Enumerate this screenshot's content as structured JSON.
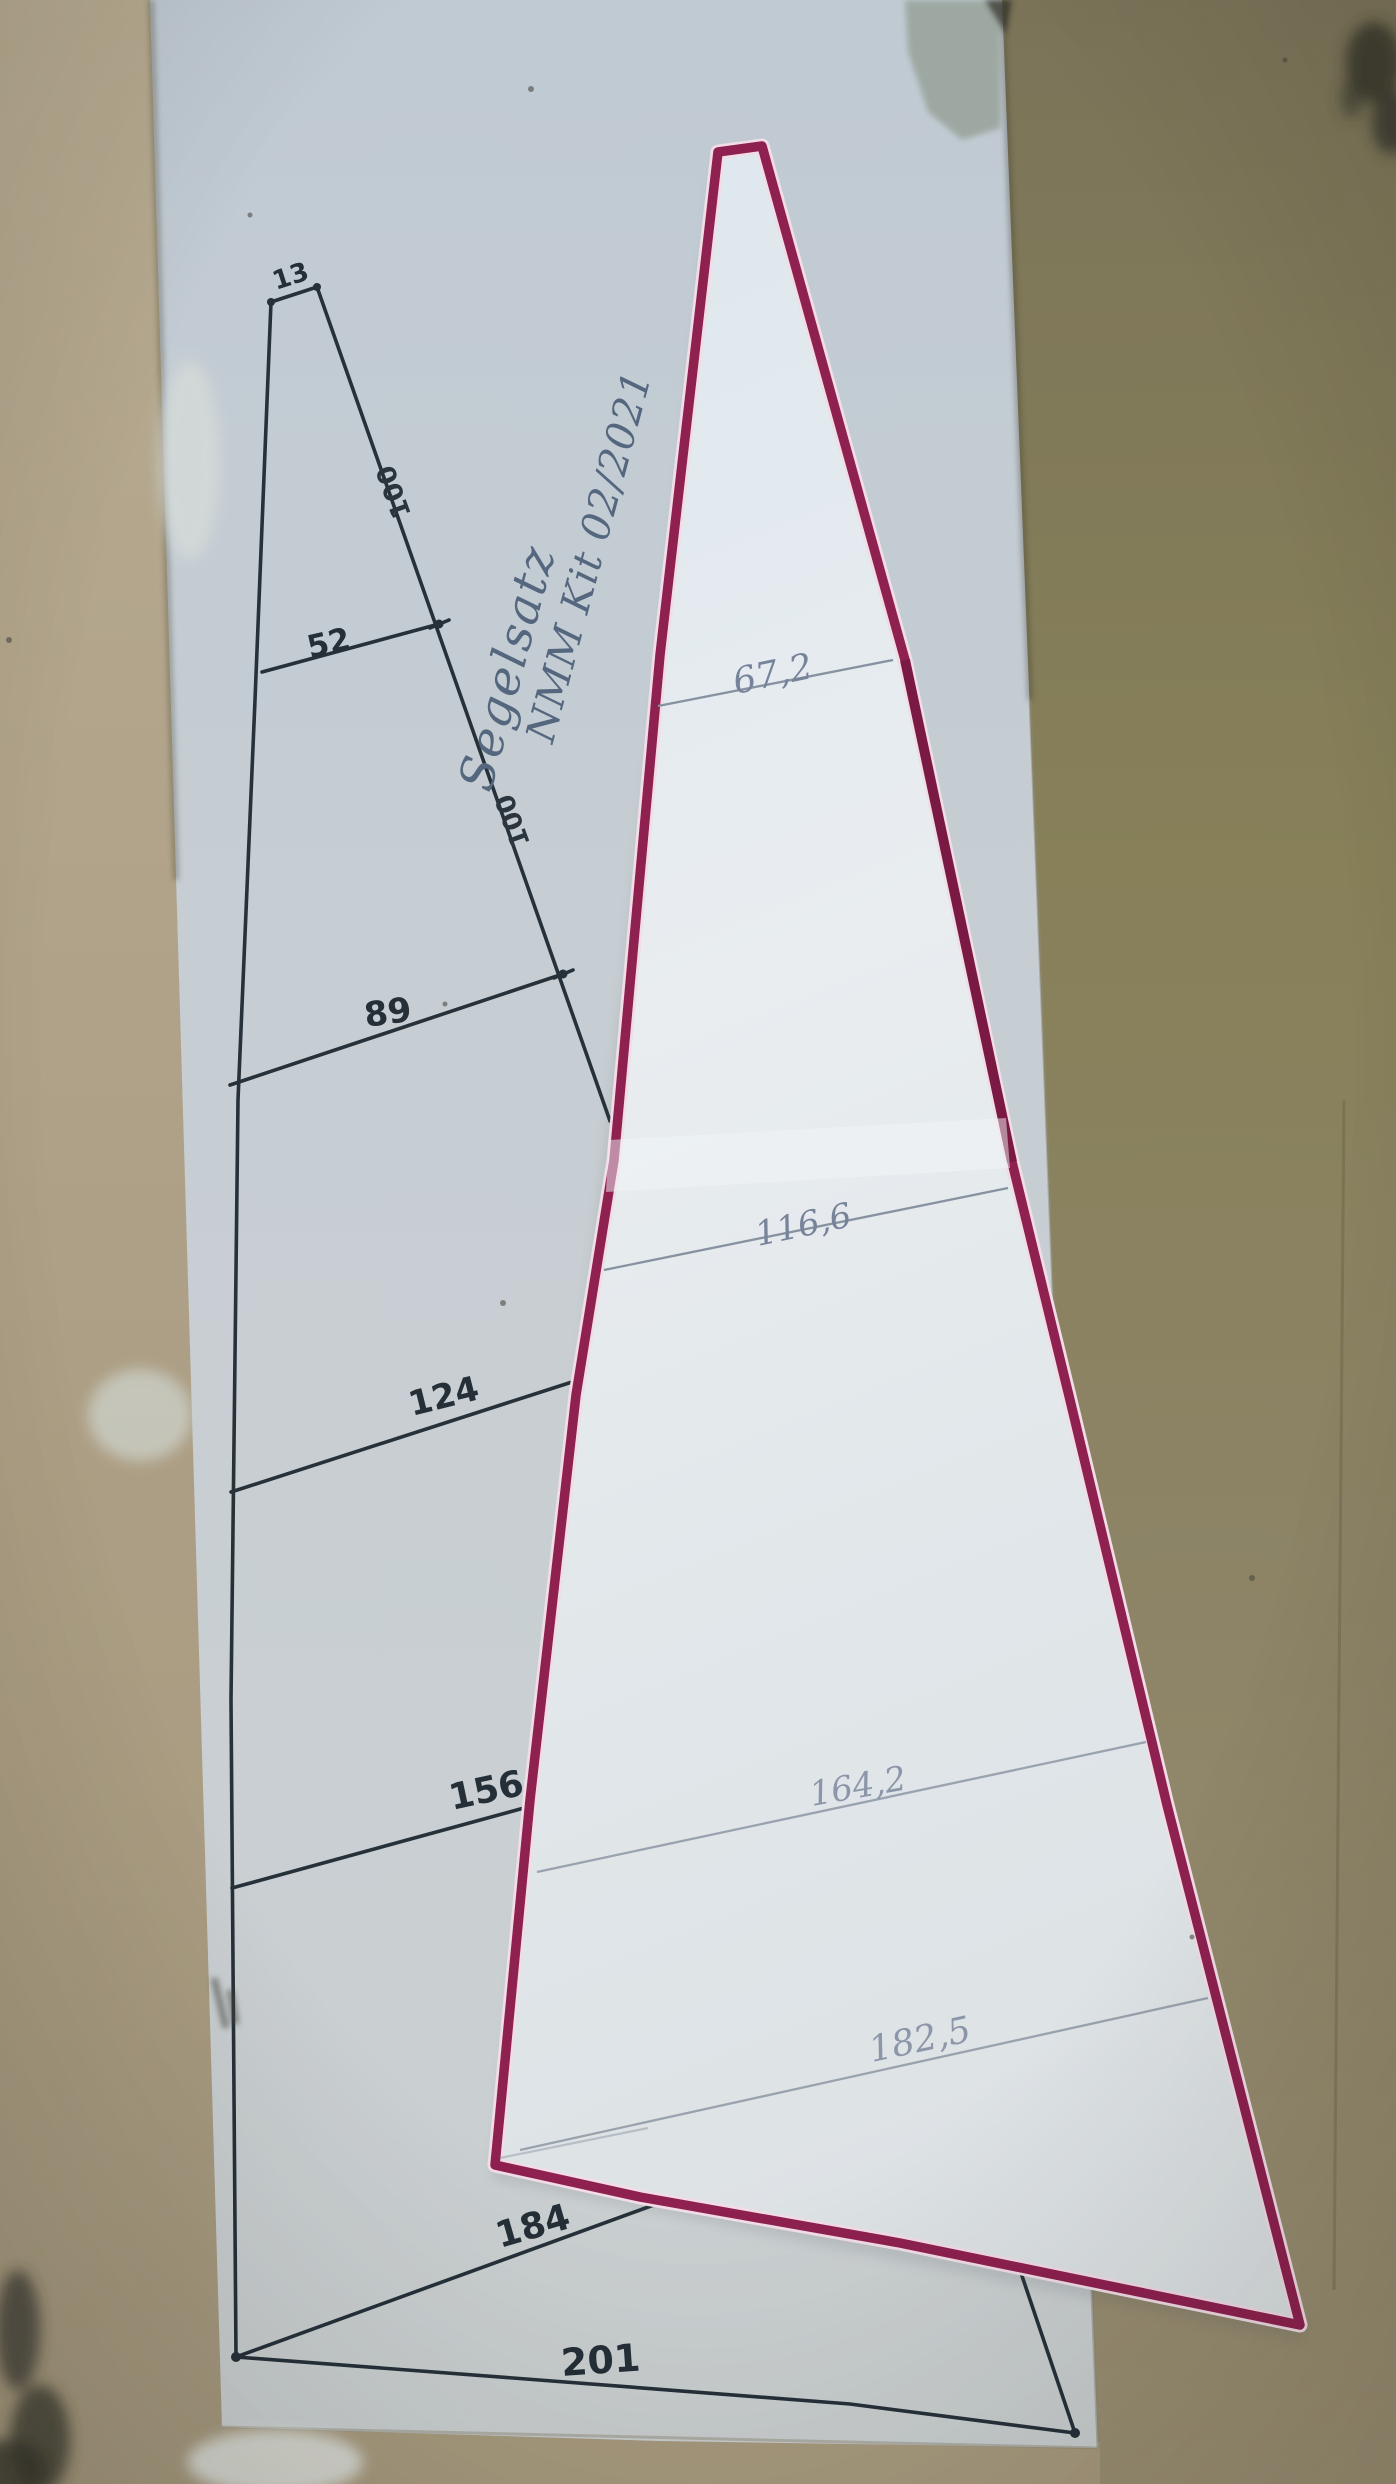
{
  "scene": {
    "type": "photograph",
    "description": "Hand-drawn model-sail plan sheet on cardboard, with a white sail template outlined in magenta marker laid over it",
    "colors": {
      "cardboard_tan": "#b3a78c",
      "cardboard_olive": "#857d61",
      "sheet_gray": "#c5cdd3",
      "sail_white": "#e4eaef",
      "sail_outline_magenta": "#8e2150",
      "ink_dark": "#26313a",
      "pencil_gray": "#8590a0",
      "handwriting_blue": "#54677e"
    }
  },
  "pattern_sheet": {
    "handwritten_title_line1": "Segelsatz",
    "handwritten_title_line2": "NMM Kit 02/2021",
    "top_width_label": "13",
    "station_width_labels": [
      "52",
      "89",
      "124",
      "156",
      "184"
    ],
    "foot_width_label": "201",
    "luff_spacing_labels": [
      "100",
      "100"
    ]
  },
  "sail_template": {
    "station_width_labels": [
      "67,2",
      "116,6",
      "164,2",
      "182,5"
    ]
  }
}
